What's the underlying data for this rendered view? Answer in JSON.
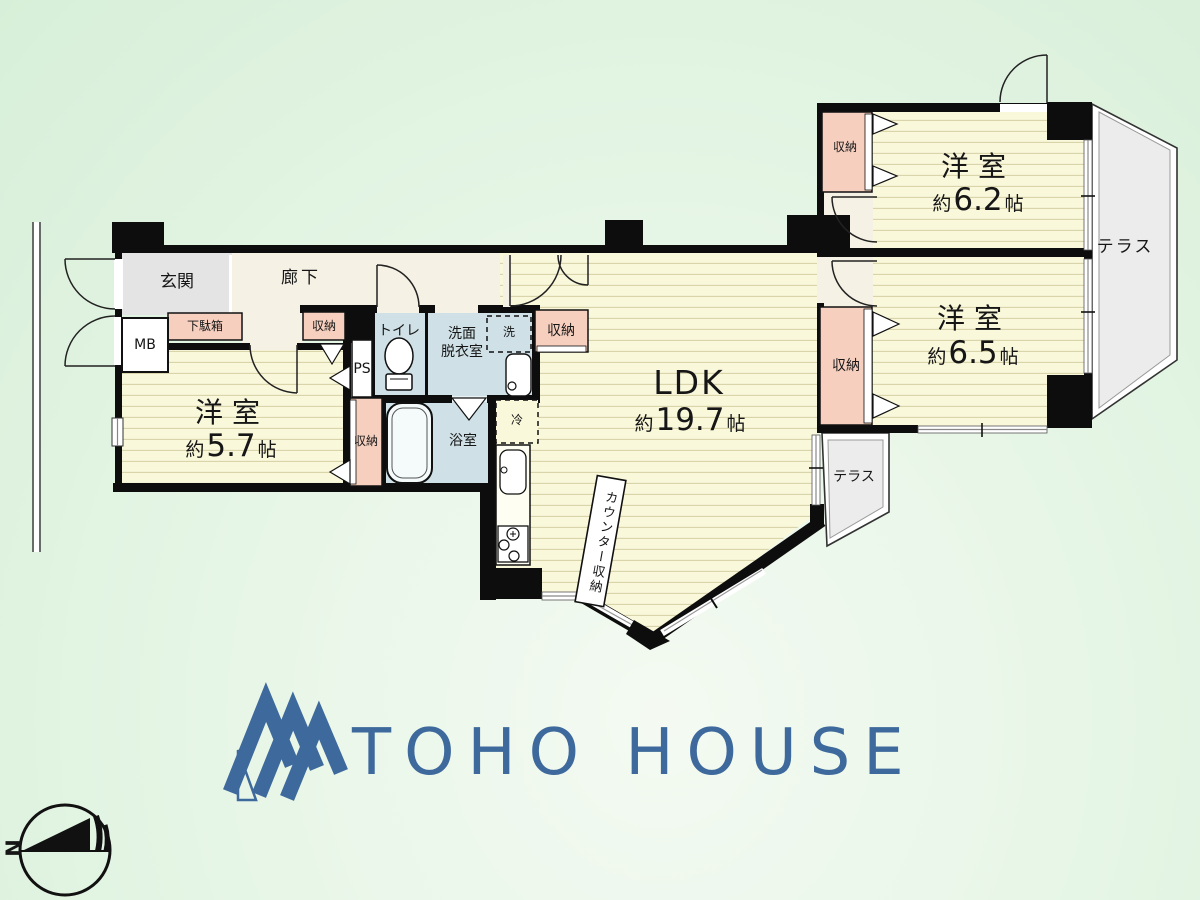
{
  "branding": {
    "company_name": "TOHO HOUSE",
    "logo_color": "#3e699c"
  },
  "compass": {
    "north_label": "N"
  },
  "palette": {
    "tatami_yellow": "#faf8db",
    "closet_pink": "#f6cfbf",
    "wet_blue": "#cfe0e6",
    "hall_cream": "#f6f1e5",
    "entry_gray": "#e4e4e4",
    "terrace_gray": "#ececec",
    "wall_black": "#0d0d0d"
  },
  "labels": {
    "entrance": "玄関",
    "hallway": "廊下",
    "shoe_cabinet": "下駄箱",
    "meter_box": "MB",
    "pipe_space": "PS",
    "toilet": "トイレ",
    "washroom_line1": "洗面",
    "washroom_line2": "脱衣室",
    "washing_machine": "洗",
    "bathroom": "浴室",
    "refrigerator": "冷",
    "counter_storage": "カウンター収納",
    "storage": "収納",
    "terrace": "テラス"
  },
  "rooms": {
    "ldk": {
      "name": "LDK",
      "approx": "約",
      "area": "19.7",
      "unit": "帖"
    },
    "western_a": {
      "name": "洋室",
      "approx": "約",
      "area": "5.7",
      "unit": "帖"
    },
    "western_b": {
      "name": "洋室",
      "approx": "約",
      "area": "6.2",
      "unit": "帖"
    },
    "western_c": {
      "name": "洋室",
      "approx": "約",
      "area": "6.5",
      "unit": "帖"
    }
  }
}
